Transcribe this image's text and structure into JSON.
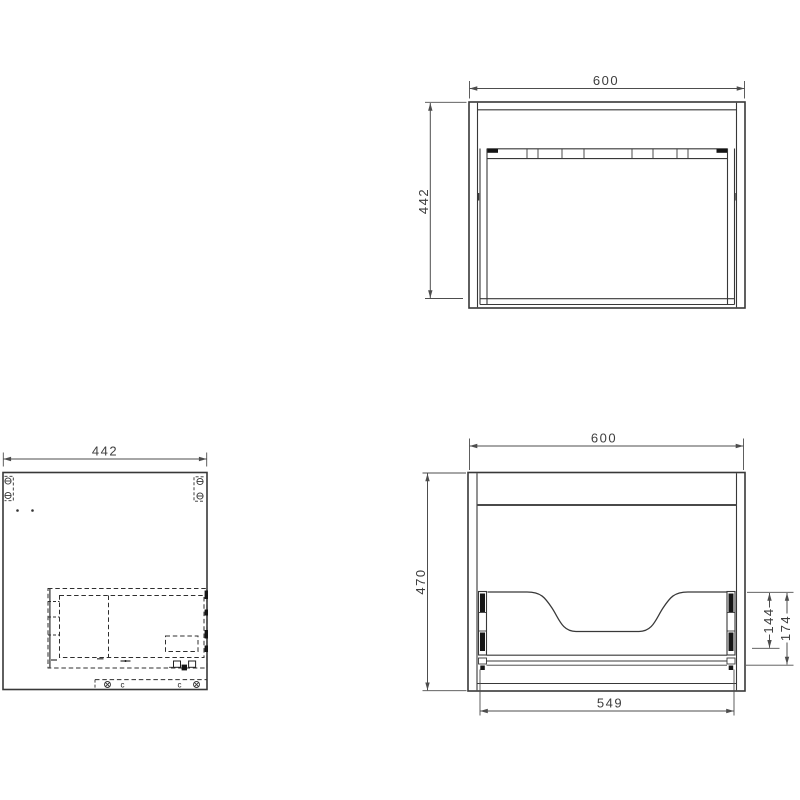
{
  "drawing": {
    "background_color": "#ffffff",
    "object_line_color": "#383838",
    "dimension_line_color": "#4d4d4d",
    "views": {
      "front": {
        "width": "600",
        "height": "442"
      },
      "side": {
        "width": "442",
        "cam_labels": [
          "c",
          "c"
        ]
      },
      "back": {
        "width": "600",
        "height": "470",
        "bottom_width": "549",
        "slide_height_inner": "144",
        "slide_height_outer": "174"
      }
    }
  }
}
